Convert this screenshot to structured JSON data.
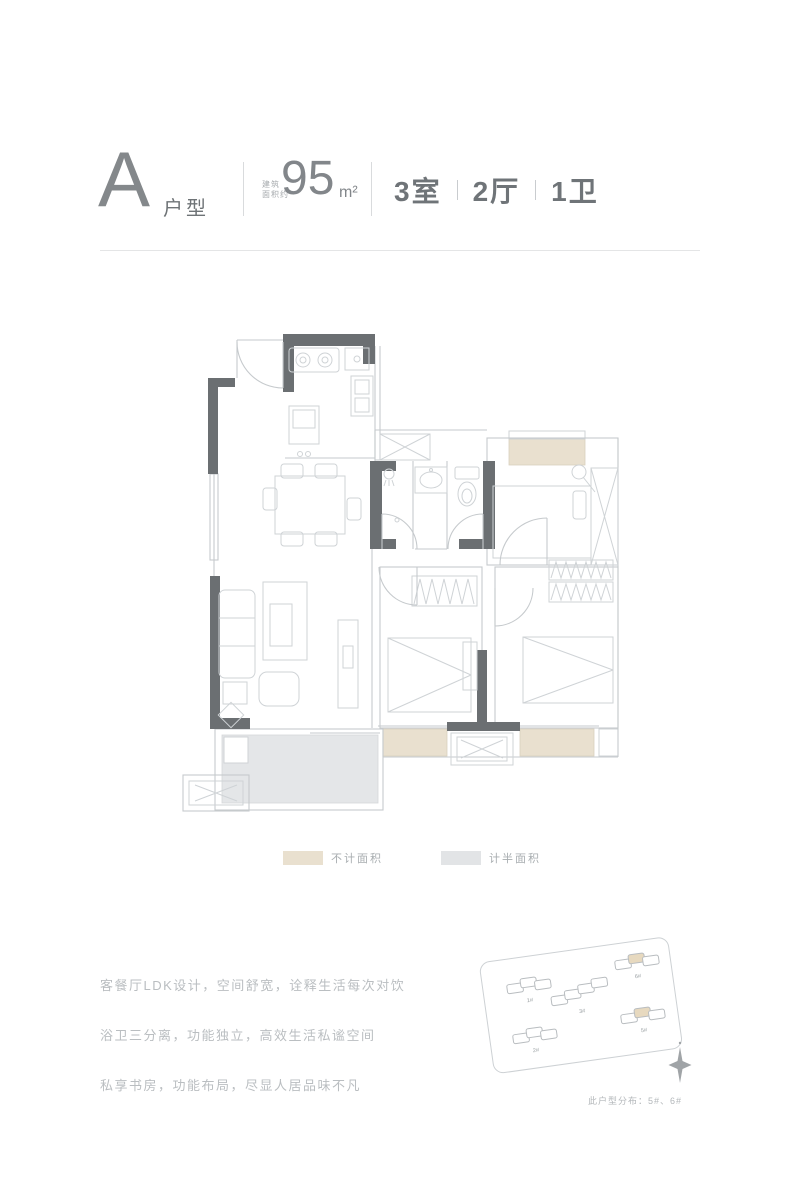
{
  "header": {
    "type_letter": "A",
    "type_suffix": "户型",
    "area_label_line1": "建筑",
    "area_label_line2": "面积约",
    "area_value": "95",
    "area_unit": "m²",
    "rooms": [
      {
        "text": "3室"
      },
      {
        "text": "2厅"
      },
      {
        "text": "1卫"
      }
    ]
  },
  "legend": {
    "items": [
      {
        "label": "不计面积",
        "color": "#e9e0cf"
      },
      {
        "label": "计半面积",
        "color": "#e2e4e6"
      }
    ]
  },
  "description": {
    "lines": [
      "客餐厅LDK设计，空间舒宽，诠释生活每次对饮",
      "浴卫三分离，功能独立，高效生活私谧空间",
      "私享书房，功能布局，尽显人居品味不凡"
    ]
  },
  "siteplan": {
    "caption": "此户型分布：5#、6#",
    "buildings": [
      {
        "label": "1#",
        "highlight": false
      },
      {
        "label": "2#",
        "highlight": false
      },
      {
        "label": "3#",
        "highlight": false
      },
      {
        "label": "5#",
        "highlight": true
      },
      {
        "label": "6#",
        "highlight": true
      }
    ],
    "compass": "north"
  },
  "colors": {
    "wall": "#6b6f72",
    "thin_line": "#c6cacd",
    "no_area_beige": "#e9e0cf",
    "half_area_gray": "#e4e6e8",
    "text_dark": "#6f7478",
    "text_light": "#babec1"
  }
}
